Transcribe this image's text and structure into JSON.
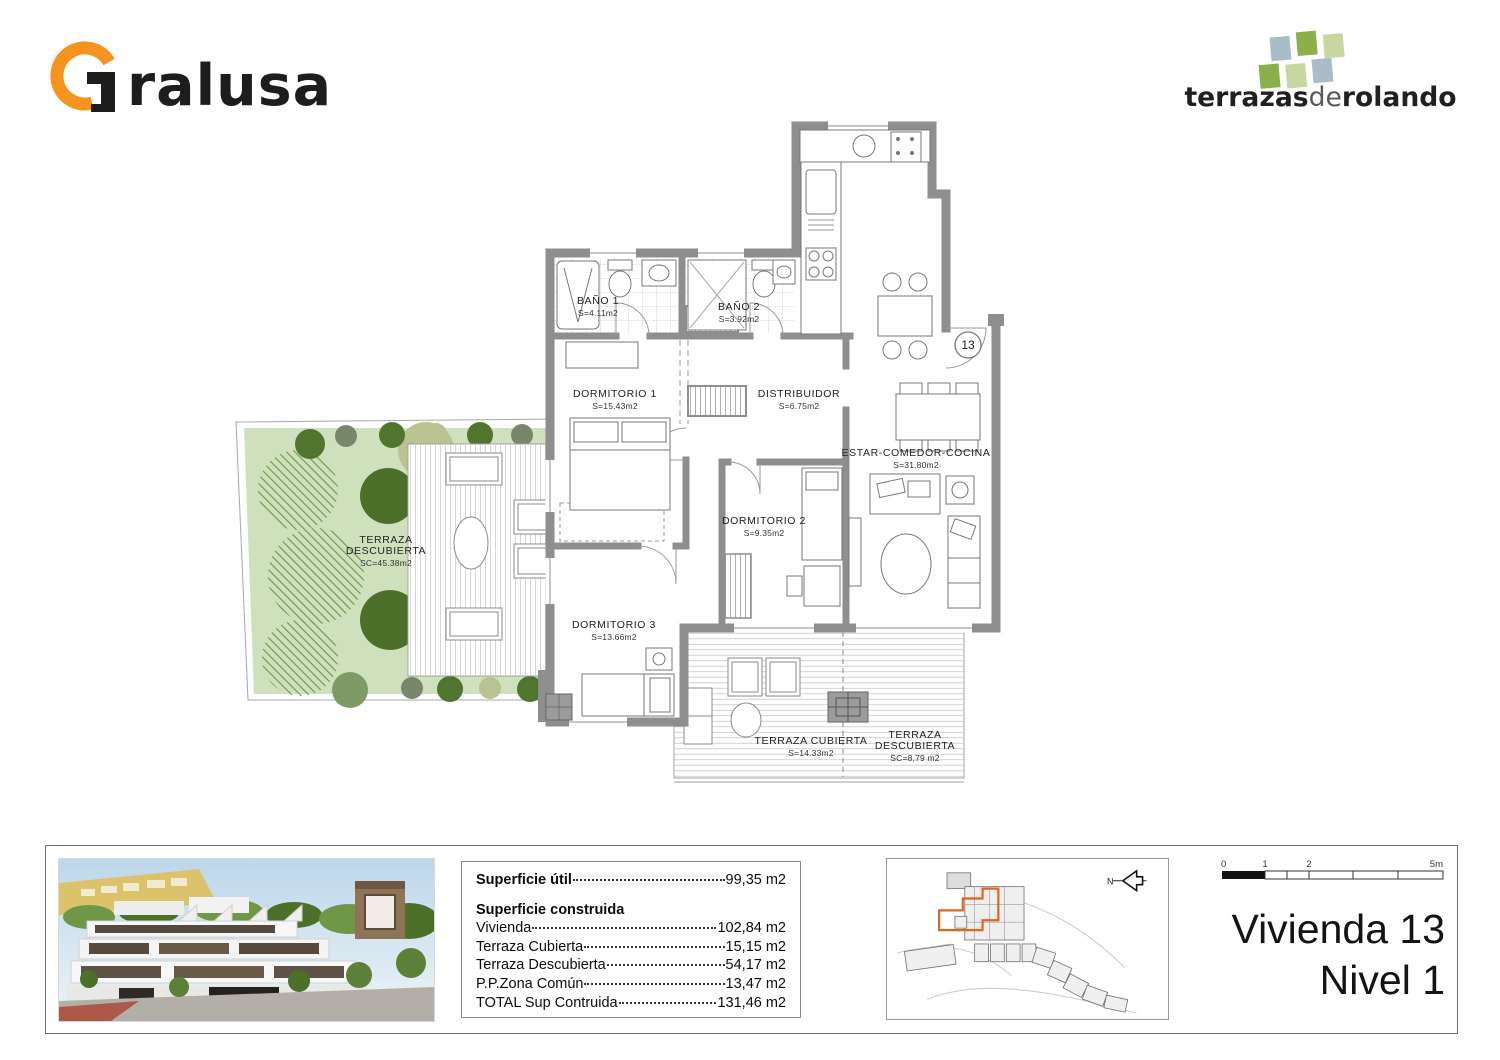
{
  "colors": {
    "accent_orange": "#F6921E",
    "logo_green": "#8bb04a",
    "logo_pale_green": "#c6d7a2",
    "logo_blue_gray": "#a9bdc9",
    "wall_gray": "#8e8e8e",
    "garden_green": "#cfe0bd",
    "site_highlight_orange": "#e0651f"
  },
  "header": {
    "brand_left_tail": "ralusa",
    "brand_right": {
      "part1": "terrazas",
      "part2": "de",
      "part3": "rolando"
    }
  },
  "floorplan": {
    "unit_badge": "13",
    "rooms": [
      {
        "name": "BAÑO 1",
        "area": "S=4.11m2",
        "x": 600,
        "y": 306
      },
      {
        "name": "BAÑO 2",
        "area": "S=3.92m2",
        "x": 741,
        "y": 312
      },
      {
        "name": "DORMITORIO 1",
        "area": "S=15.43m2",
        "x": 617,
        "y": 399
      },
      {
        "name": "DISTRIBUIDOR",
        "area": "S=6.75m2",
        "x": 801,
        "y": 399
      },
      {
        "name": "ESTAR-COMEDOR-COCINA",
        "area": "S=31.80m2",
        "x": 918,
        "y": 458
      },
      {
        "name": "DORMITORIO 2",
        "area": "S=9.35m2",
        "x": 766,
        "y": 526
      },
      {
        "name": "DORMITORIO 3",
        "area": "S=13.66m2",
        "x": 616,
        "y": 630
      },
      {
        "name": "TERRAZA",
        "name2": "DESCUBIERTA",
        "area": "SC=45.38m2",
        "x": 388,
        "y": 545
      },
      {
        "name": "TERRAZA CUBIERTA",
        "area": "S=14.33m2",
        "x": 813,
        "y": 746
      },
      {
        "name": "TERRAZA",
        "name2": "DESCUBIERTA",
        "area": "SC=8,79 m2",
        "x": 917,
        "y": 740
      }
    ]
  },
  "info_panel": {
    "util_label": "Superficie útil",
    "util_value": "99,35 m2",
    "construida_title": "Superficie construida",
    "rows": [
      {
        "label": "Vivienda",
        "value": "102,84 m2"
      },
      {
        "label": "Terraza Cubierta",
        "value": "15,15 m2"
      },
      {
        "label": "Terraza Descubierta",
        "value": "54,17 m2"
      },
      {
        "label": "P.P.Zona Común",
        "value": "13,47 m2"
      },
      {
        "label": "TOTAL Sup Contruida",
        "value": "131,46 m2"
      }
    ]
  },
  "site_plan": {
    "north_label": "N"
  },
  "scale_bar": {
    "labels": [
      "0",
      "1",
      "2",
      "5m"
    ]
  },
  "title_block": {
    "line1": "Vivienda 13",
    "line2": "Nivel 1"
  }
}
